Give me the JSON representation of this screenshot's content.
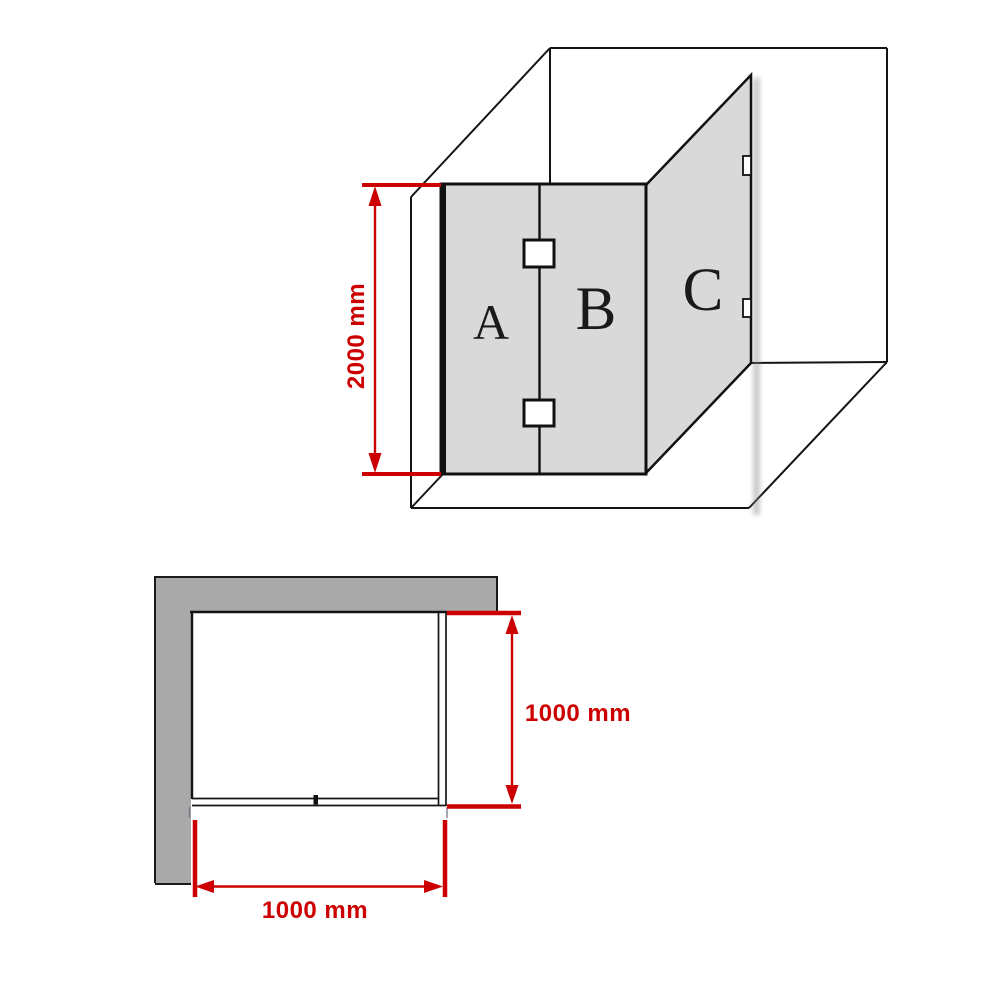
{
  "iso_view": {
    "description": "3D corner view of frameless shower screen with three glass panels",
    "panels": [
      {
        "label": "A"
      },
      {
        "label": "B"
      },
      {
        "label": "C"
      }
    ],
    "height_dimension": {
      "value": 2000,
      "unit": "mm",
      "label": "2000 mm"
    }
  },
  "plan_view": {
    "description": "Top-down plan of shower enclosure against L-shaped wall",
    "depth_dimension": {
      "value": 1000,
      "unit": "mm",
      "label": "1000 mm"
    },
    "width_dimension": {
      "value": 1000,
      "unit": "mm",
      "label": "1000 mm"
    }
  },
  "colors": {
    "dimension_red": "#cc0000",
    "glass_gray": "#d9d9d9",
    "wall_gray": "#a9a9a9",
    "line_black": "#141414",
    "background": "#ffffff"
  }
}
